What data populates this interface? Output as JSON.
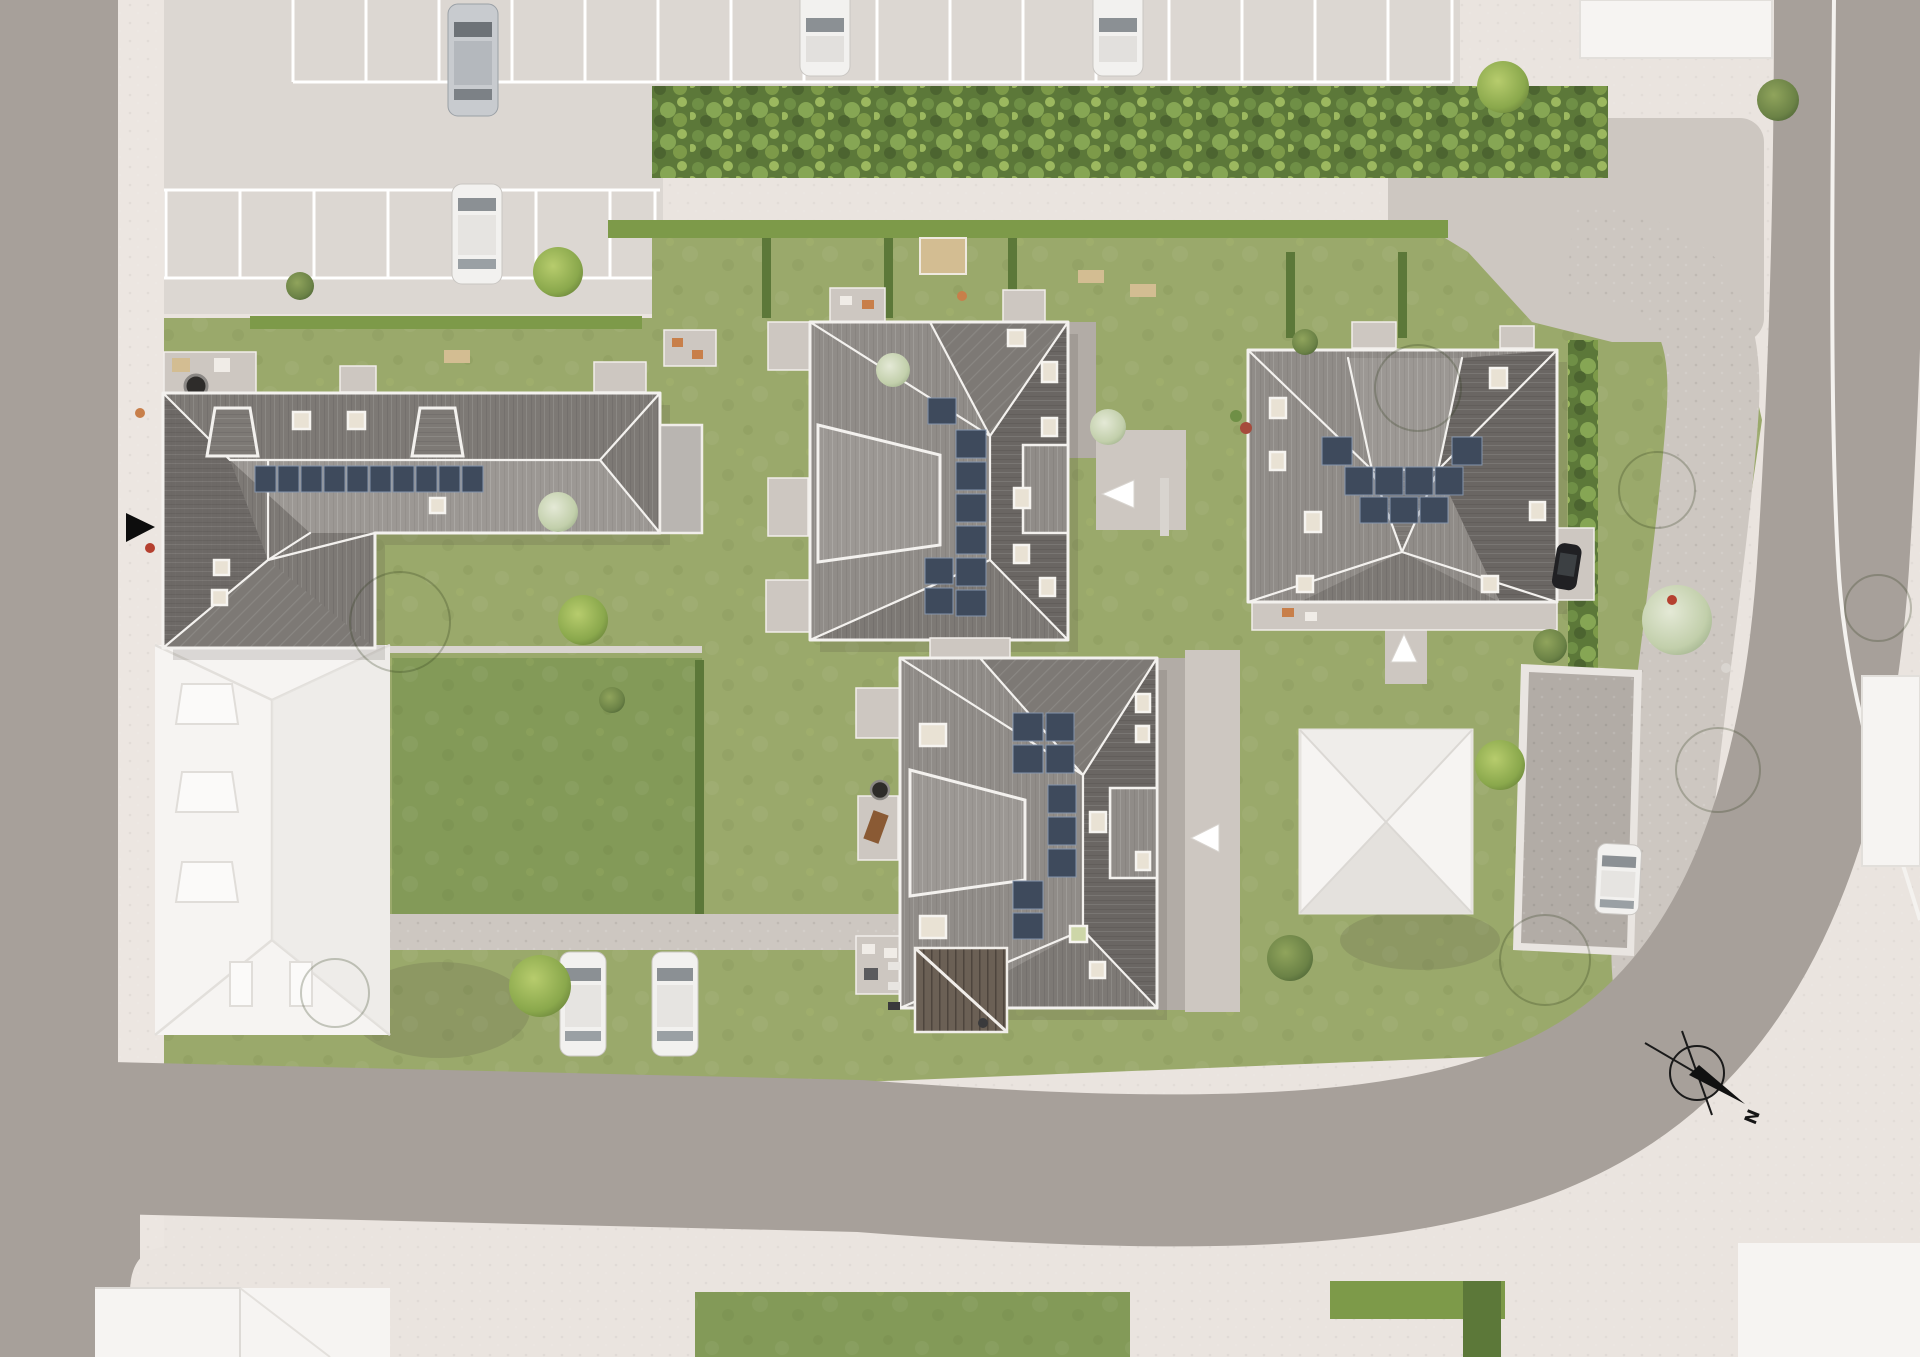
{
  "scene": {
    "type": "aerial-site-plan-rendering",
    "description": "top-down color site plan of a residential development"
  },
  "compass": {
    "label": "N"
  },
  "site": {
    "new_buildings": 4,
    "existing_white_buildings": 5,
    "entrance_markers_white": 3,
    "entrance_markers_black": 1,
    "parked_cars_visible": 8,
    "parking_rows": 2,
    "solar_roofs": 4,
    "garage_buildings": 1
  },
  "palette": {
    "road": "#a7a09a",
    "sidewalk": "#eae4df",
    "parking": "#dcd7d2",
    "cobble": "#cdc7c1",
    "cobble-dark": "#b2aca6",
    "grass": "#9aa96b",
    "lawn-dark": "#839a58",
    "hedge": "#5c7839",
    "hedge-light": "#7d9a49",
    "roof-light": "#908c88",
    "roof-mid": "#7d7975",
    "roof-dark": "#6a6663",
    "roof-pale": "#9c9894",
    "eave": "#f3f1ee",
    "solar": "#3e4a5c",
    "white-bldg": "#f6f4f2",
    "white-shade": "#e8e5e1",
    "sand": "#d3bd92",
    "shadow": "#4a453f",
    "car-white": "#f2f1ef",
    "car-silver": "#c8cbcf",
    "car-black": "#202023"
  }
}
